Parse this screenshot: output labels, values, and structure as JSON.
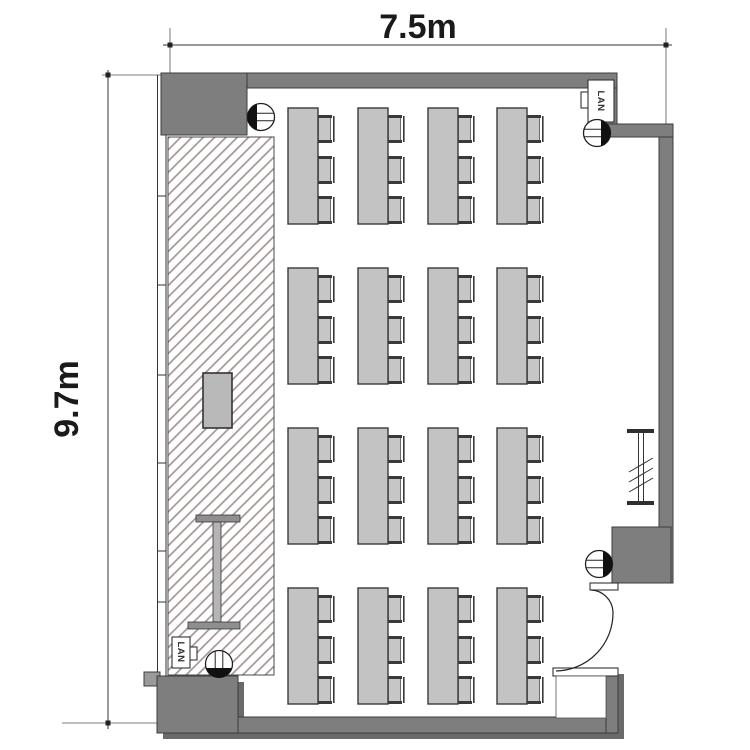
{
  "plan": {
    "width_label": "7.5m",
    "height_label": "9.7m",
    "lan_label_top": "LAN",
    "lan_label_bottom": "LAN"
  },
  "colors": {
    "wall": "#7e7e7e",
    "wall_shadow": "#6a6a6a",
    "wall_step": "#9a9a9a",
    "table_fill": "#c3c3c3",
    "table_stroke": "#3a3a3a",
    "chair_fill": "#c6c6c6",
    "chair_dark": "#3a3a3a",
    "hatch_line": "#a59696",
    "podium_fill": "#b9b9b9",
    "screen_bar": "#8f8f8f",
    "screen_stem": "#b5b5b5",
    "outlet_dark": "#111111"
  },
  "furniture": {
    "table_count": 16,
    "chairs_per_table": 3,
    "columns_x": [
      288,
      358,
      428,
      497
    ],
    "rows_y": [
      108,
      268,
      428,
      588
    ],
    "table_width": 30,
    "table_height": 116,
    "chair_offsets_y": [
      7,
      48,
      88
    ],
    "chair_width": 17,
    "chair_height": 28
  },
  "outlets": [
    {
      "x": 261,
      "y": 117,
      "side": "left"
    },
    {
      "x": 597,
      "y": 133,
      "side": "right"
    },
    {
      "x": 599,
      "y": 564,
      "side": "right"
    },
    {
      "x": 219,
      "y": 664,
      "side": "bottom"
    }
  ]
}
